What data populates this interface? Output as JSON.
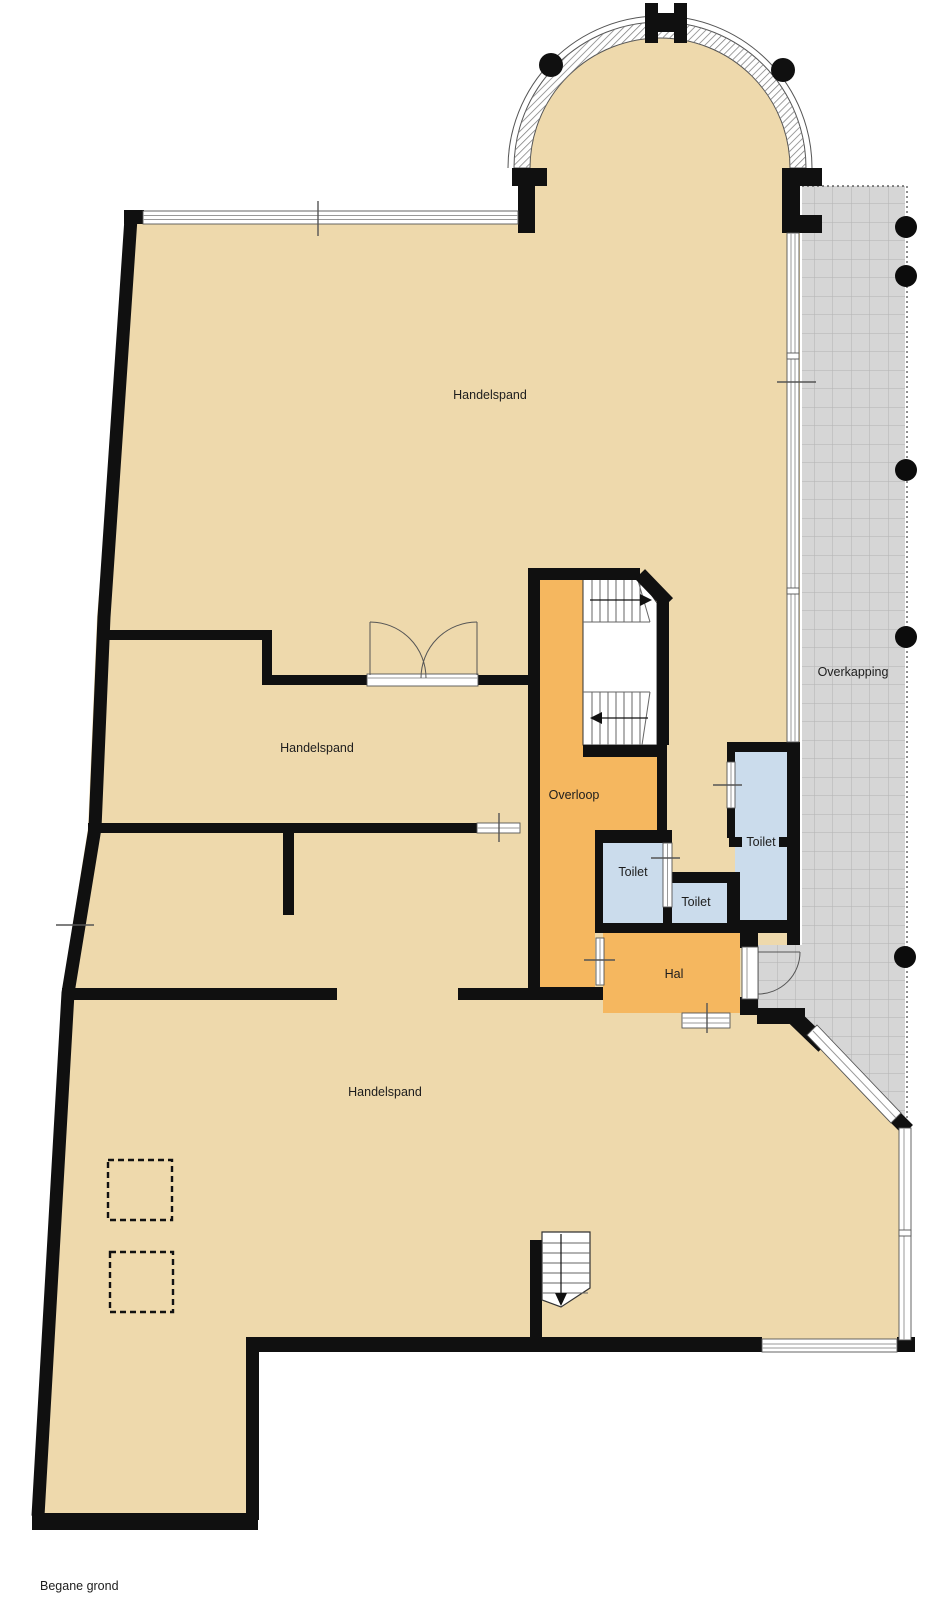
{
  "plan": {
    "floor_label": "Begane grond",
    "rooms": [
      {
        "id": "handelspand-top",
        "label": "Handelspand"
      },
      {
        "id": "handelspand-middle",
        "label": "Handelspand"
      },
      {
        "id": "handelspand-bottom",
        "label": "Handelspand"
      },
      {
        "id": "overloop",
        "label": "Overloop"
      },
      {
        "id": "toilet-left",
        "label": "Toilet"
      },
      {
        "id": "toilet-middle",
        "label": "Toilet"
      },
      {
        "id": "toilet-right",
        "label": "Toilet"
      },
      {
        "id": "hal",
        "label": "Hal"
      },
      {
        "id": "overkapping",
        "label": "Overkapping"
      }
    ]
  },
  "colors": {
    "floor": "#eed9ac",
    "landing": "#f5b75f",
    "wc": "#cbdcec",
    "canopy": "#d6d6d6",
    "wall": "#101010"
  }
}
